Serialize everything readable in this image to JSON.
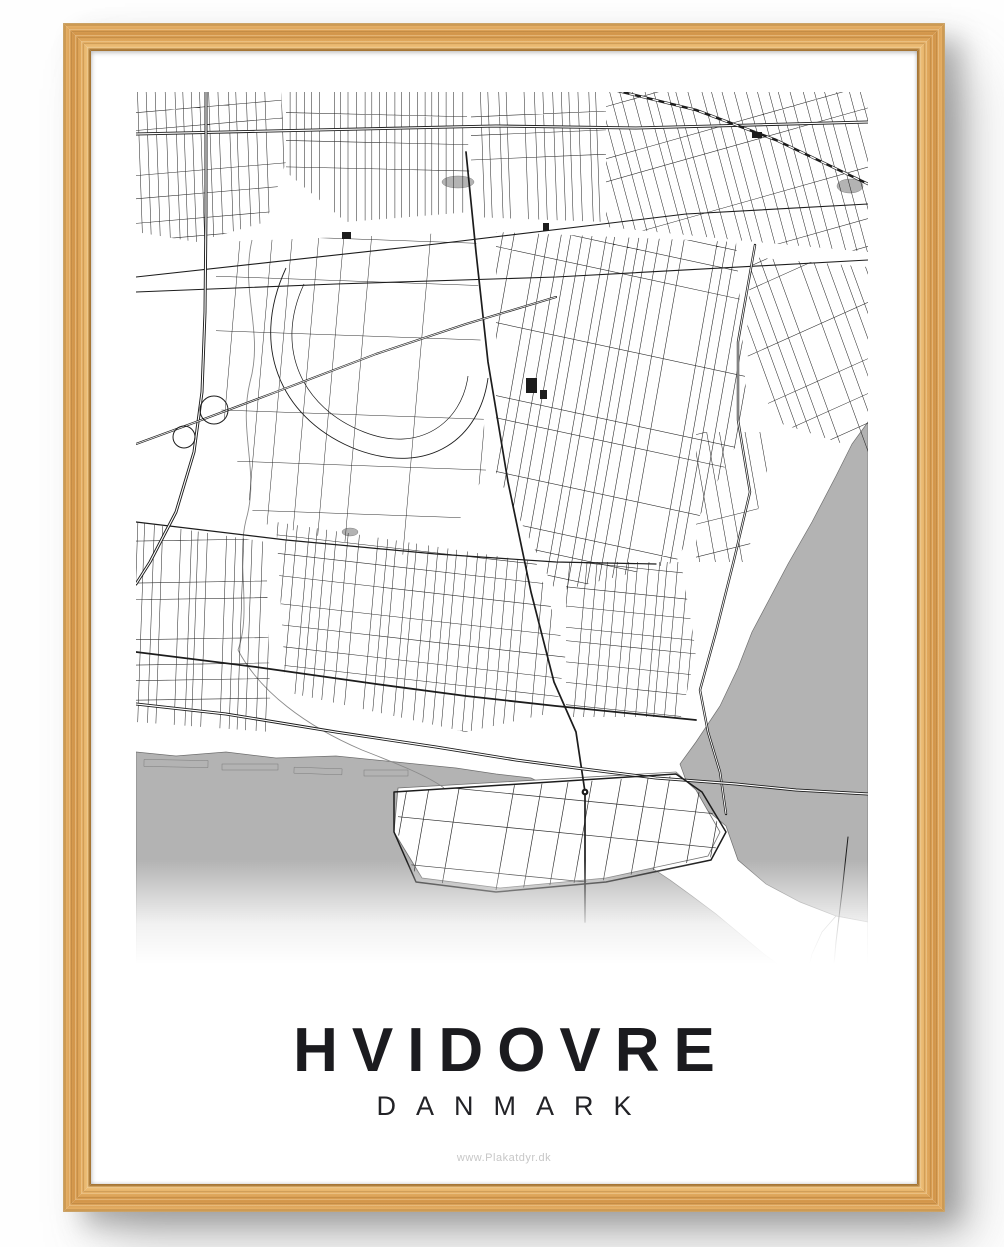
{
  "poster": {
    "title": "HVIDOVRE",
    "subtitle": "DANMARK",
    "footer": "www.Plakatdyr.dk"
  },
  "map": {
    "label": "street-map-of-hvidovre",
    "colors": {
      "land": "#ffffff",
      "water": "#b3b3b3",
      "street": "#1c1c1c",
      "coast": "#6f6f6f",
      "river": "#8a8a8a"
    }
  },
  "frame": {
    "wood_base": "#d2954a",
    "wood_highlight": "#edbf78",
    "wood_shadow": "#9c6b2b",
    "title_color": "#1b1b1f",
    "footer_color": "#c7c7c7"
  }
}
